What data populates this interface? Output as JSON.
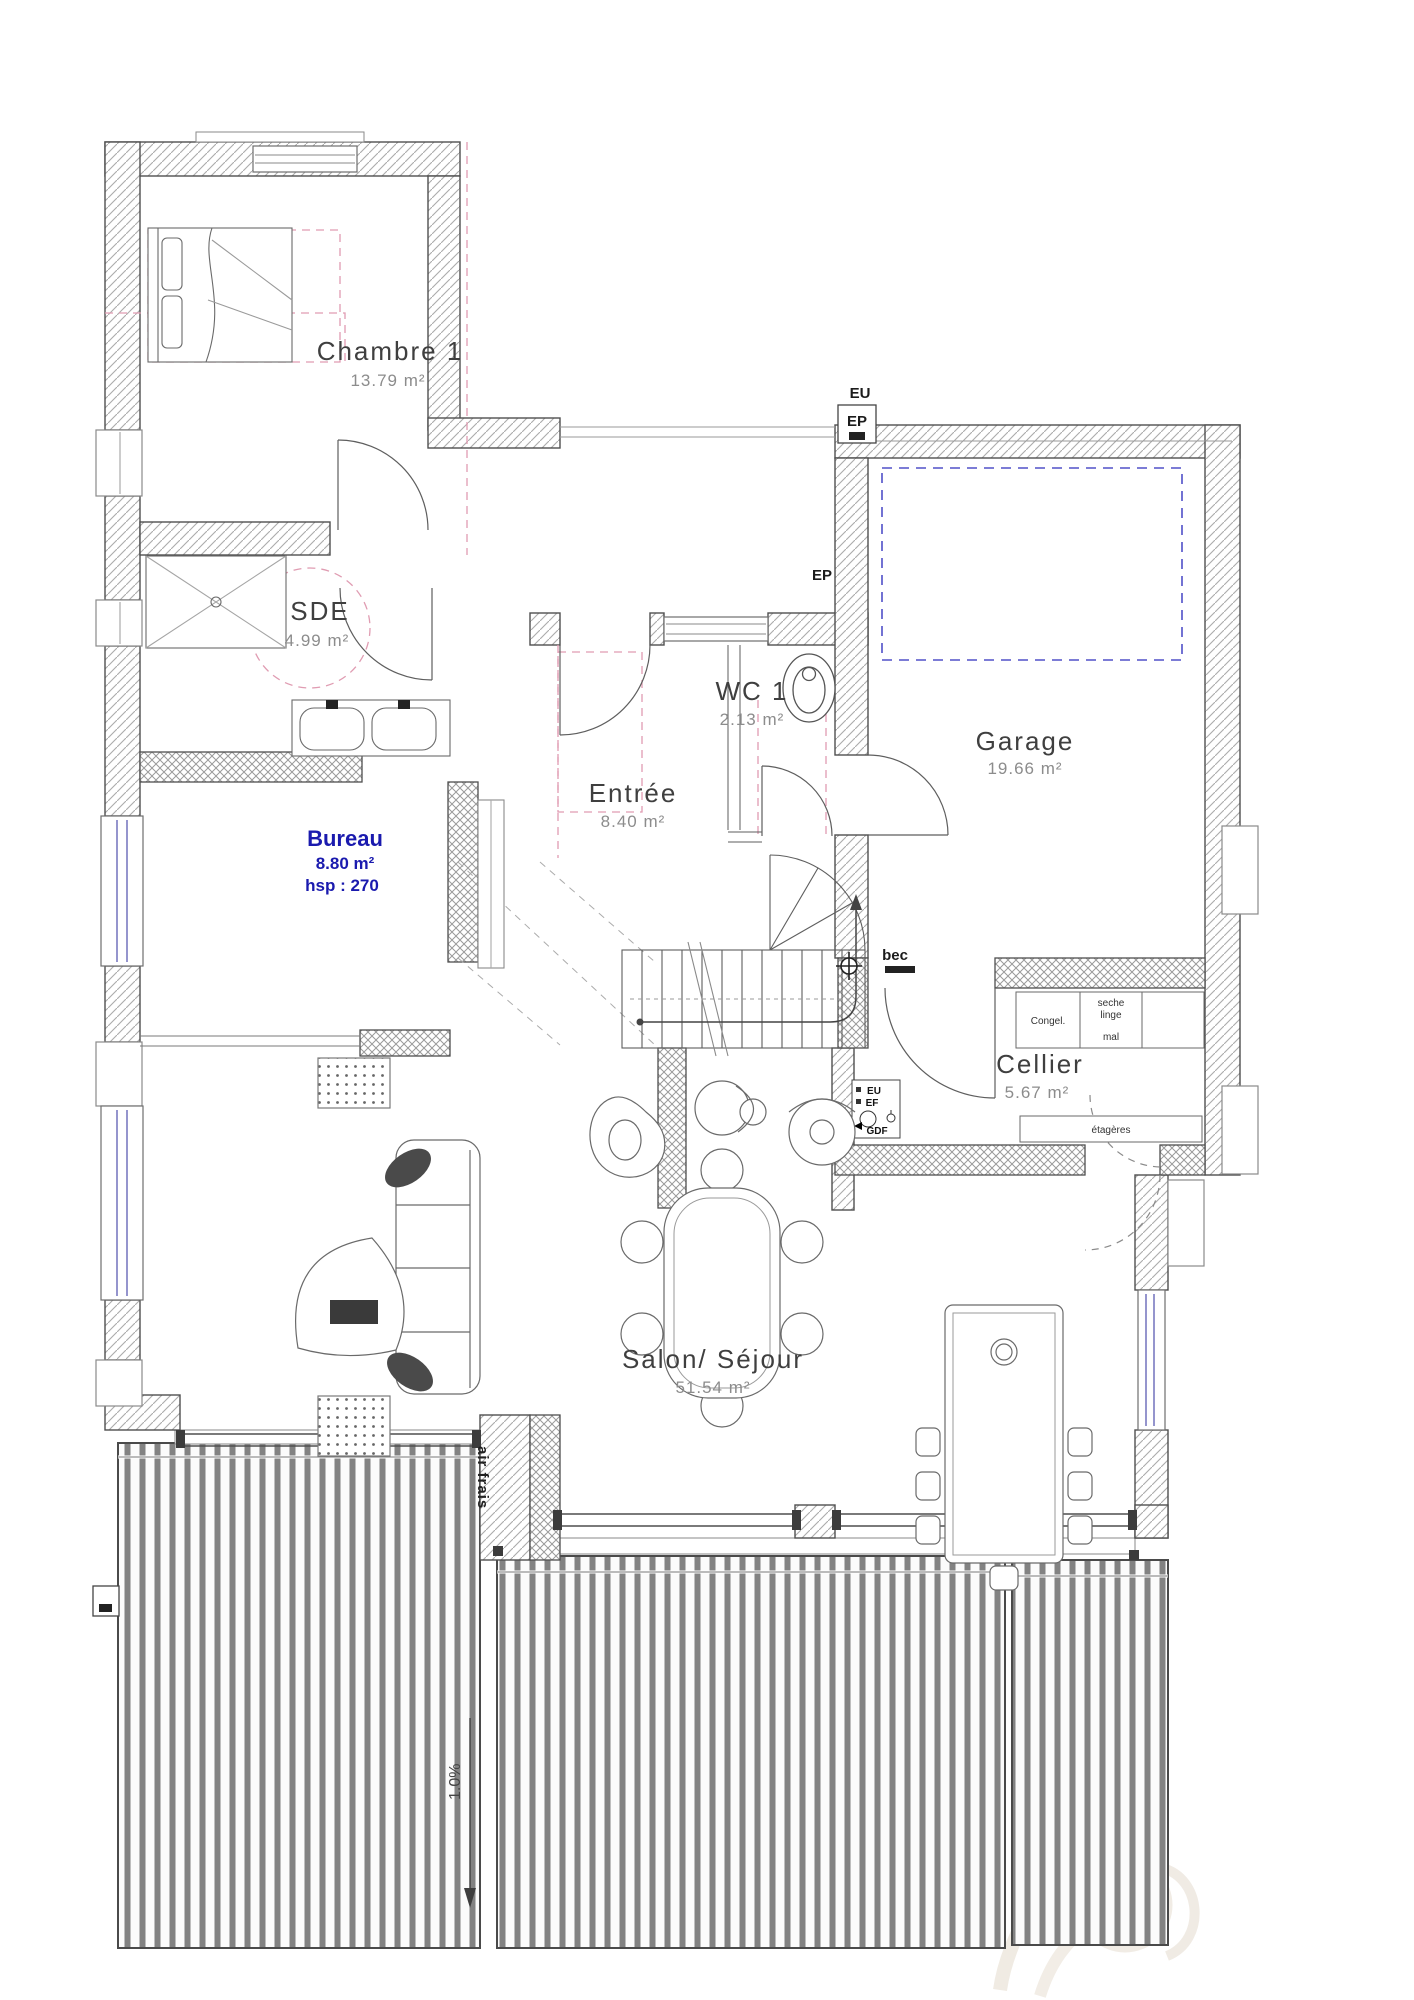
{
  "rooms": [
    {
      "name": "Chambre 1",
      "area": "13.79 m²"
    },
    {
      "name": "SDE",
      "area": "4.99 m²"
    },
    {
      "name": "Bureau",
      "area": "8.80 m²",
      "hsp": "hsp : 270"
    },
    {
      "name": "Entrée",
      "area": "8.40 m²"
    },
    {
      "name": "WC 1",
      "area": "2.13 m²"
    },
    {
      "name": "Garage",
      "area": "19.66 m²"
    },
    {
      "name": "Cellier",
      "area": "5.67 m²"
    },
    {
      "name": "Salon/ Séjour",
      "area": "51.54 m²"
    }
  ],
  "annotations": {
    "eu_top": "EU",
    "ep_garage": "EP",
    "ep_entree": "EP",
    "bec": "bec",
    "utility_eu": "EU",
    "utility_ef": "EF",
    "utility_gdf": "GDF",
    "air_frais": "air frais",
    "slope": "1.0%"
  },
  "fixtures": {
    "freezer": "Congel.",
    "dryer_top": "seche",
    "dryer_mid": "linge",
    "dryer_bottom": "mal",
    "shelves": "étagères"
  },
  "colors": {
    "wall_line": "#4f4f4f",
    "pink_dashed": "#e09cb2",
    "blue_dashed": "#5050c8",
    "bureau_text": "#1a1aae",
    "room_text": "#3f3f3f",
    "area_text": "#8c8c8c"
  }
}
